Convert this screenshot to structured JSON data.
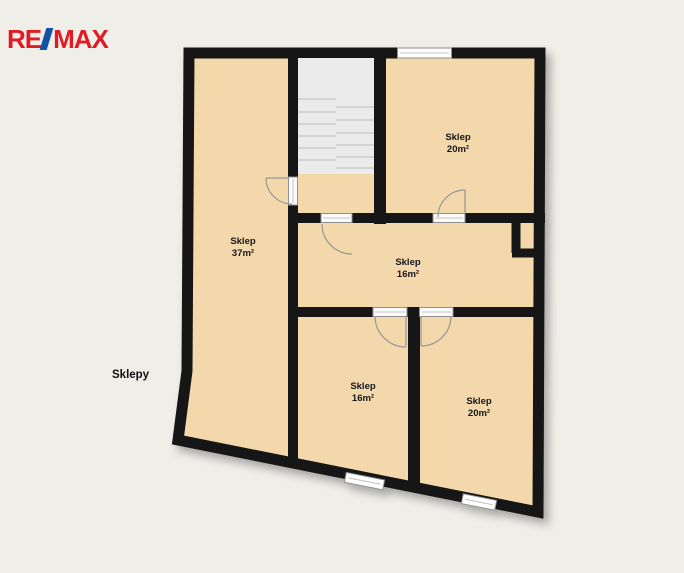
{
  "logo": {
    "part1": "RE",
    "slash": "/",
    "part2": "MAX"
  },
  "page_label": "Sklepy",
  "rooms": [
    {
      "id": "sklep-left",
      "name": "Sklep",
      "area": "37m²"
    },
    {
      "id": "sklep-top-right",
      "name": "Sklep",
      "area": "20m²"
    },
    {
      "id": "sklep-middle",
      "name": "Sklep",
      "area": "16m²"
    },
    {
      "id": "sklep-bottom-middle",
      "name": "Sklep",
      "area": "16m²"
    },
    {
      "id": "sklep-bottom-right",
      "name": "Sklep",
      "area": "20m²"
    }
  ],
  "icons": {
    "logo_slash": "skewed-diagonal-bar"
  },
  "colors": {
    "background": "#f0eee9",
    "floor": "#f2d8aa",
    "wall": "#141414",
    "stair_fill": "#ebebeb",
    "brand_red": "#df1b24",
    "brand_blue": "#1053a5",
    "label_color": "#15151f"
  }
}
